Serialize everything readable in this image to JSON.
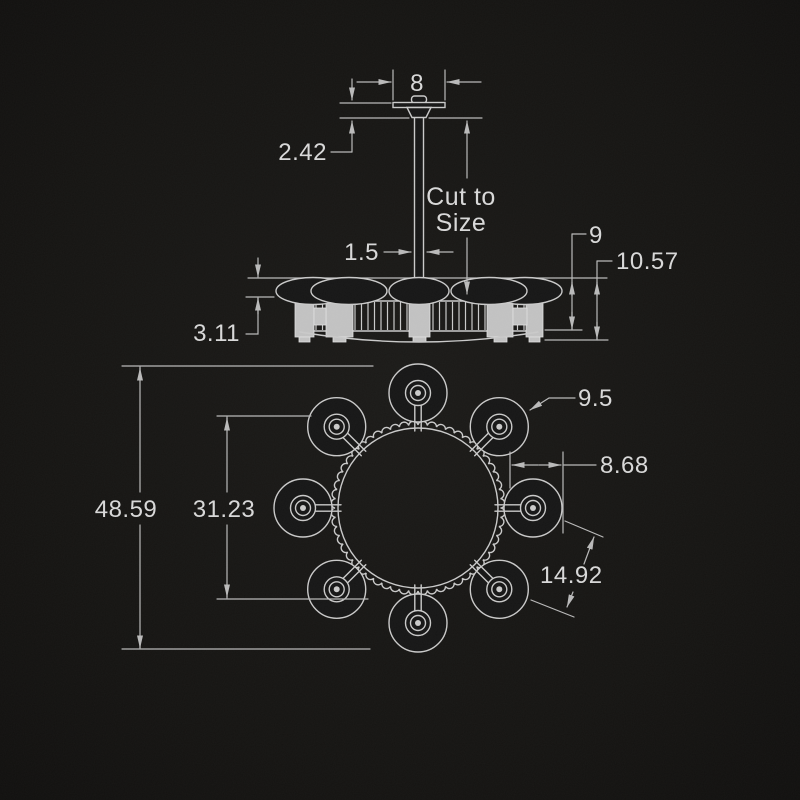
{
  "colors": {
    "background": "#151412",
    "line": "#c9c9c9",
    "dimension_line": "#b9b9b9",
    "text": "#d8d8d8",
    "block_fill": "#c2c2c2"
  },
  "elevation": {
    "canopy_width": "8",
    "canopy_height": "2.42",
    "rod_note_line1": "Cut to",
    "rod_note_line2": "Size",
    "rod_width": "1.5",
    "body_height": "9",
    "overall_drop": "10.57",
    "shade_height": "3.11"
  },
  "plan": {
    "shade_diameter": "9.5",
    "shade_overhang": "8.68",
    "overall_diameter": "48.59",
    "across_centers": "31.23",
    "shade_spacing": "14.92"
  }
}
